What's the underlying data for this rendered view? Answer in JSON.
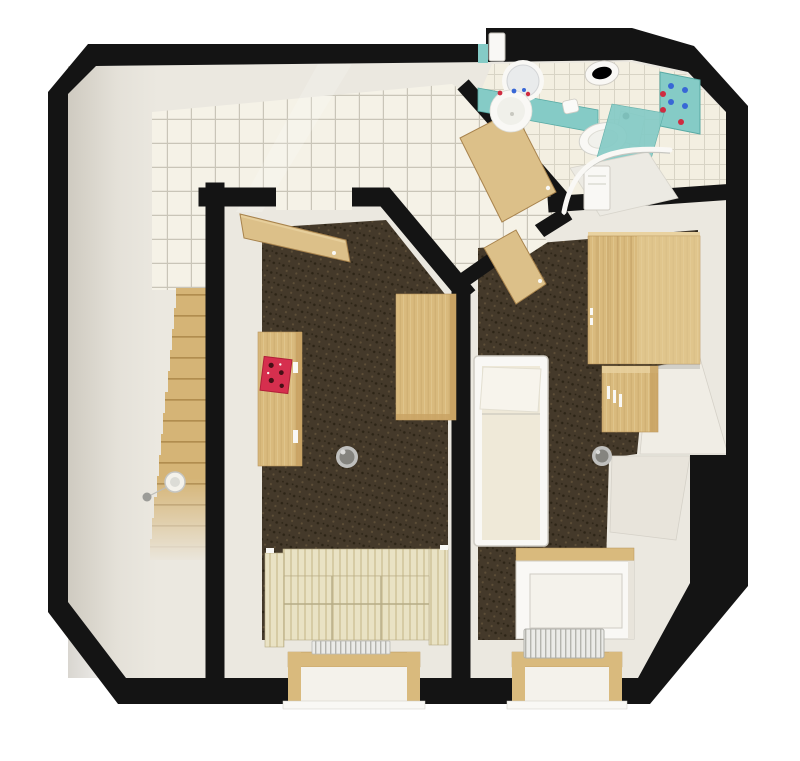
{
  "scene": {
    "title": "3D rendered floor plan, top-down view of an attic apartment",
    "background": "#ffffff",
    "rooms": [
      {
        "id": "hallway",
        "label": "hallway",
        "floor": "smooth light floor",
        "objects": [
          "staircase",
          "ceiling-lamp"
        ]
      },
      {
        "id": "kitchen",
        "label": "kitchen",
        "floor": "white square tiles",
        "objects": []
      },
      {
        "id": "living-room",
        "label": "living room",
        "floor": "dark brown carpet",
        "objects": [
          "open-wooden-door",
          "sideboard",
          "magazine",
          "table",
          "waste-bin",
          "striped-sofa",
          "radiator",
          "window-bay"
        ]
      },
      {
        "id": "bedroom",
        "label": "bedroom",
        "floor": "dark brown carpet",
        "objects": [
          "open-wooden-door",
          "double-bed",
          "wardrobe",
          "chest-of-drawers",
          "waste-bin",
          "sloped-ceiling-panels",
          "white-dresser",
          "radiator",
          "window-bay"
        ]
      },
      {
        "id": "bathroom",
        "label": "bathroom",
        "floor": "white square tiles",
        "objects": [
          "top-wall-door",
          "vanity-counter",
          "round-mirror",
          "washbasin",
          "toilet-paper-roll",
          "bidet",
          "toilet",
          "toiletry-cabinet",
          "shower"
        ]
      }
    ]
  },
  "palette": {
    "wall": "#141414",
    "base": "#ebe8e0",
    "baseBright": "#f4f2eb",
    "hallShadow": "#b3ada1",
    "tile": "#f5f2e7",
    "grout": "#c9c5b8",
    "tileBath": "#f3efe1",
    "groutBath": "#d8d4c5",
    "carpet": "#44392a",
    "carpetDot1": "#2c2416",
    "carpetDot2": "#5e4f38",
    "wood": "#d9ba7d",
    "woodLight": "#e9d2a0",
    "woodDark": "#b8935a",
    "woodShade": "#c8a263",
    "stairWood": "#d5b476",
    "stairLine": "#aa8648",
    "teal": "#85cbc6",
    "tealEdge": "#58aaa4",
    "doorWood": "#dcc089",
    "doorEdge": "#a8834d",
    "white": "#f9f8f5",
    "whiteEdge": "#cfccc4",
    "mattress": "#efe9d8",
    "pillow": "#f7f4ec",
    "sofa": "#e9e2c4",
    "sofaStripe": "#d6cba4",
    "sofaEdge": "#b6ab85",
    "radiator": "#ebebe8",
    "radiatorFin": "#b4b4ae",
    "slope1": "#f0ede5",
    "slope2": "#e8e4db",
    "slopeEdge": "#d5d1c8",
    "binRim": "#c0c0be",
    "binBody": "#85847f",
    "binHi": "#dadad8",
    "red": "#cf2b40",
    "blue": "#3867d6",
    "magazine": "#d62f4e",
    "magDark": "#451016",
    "paper": "#fafaf8",
    "beam": "#ffffff"
  }
}
